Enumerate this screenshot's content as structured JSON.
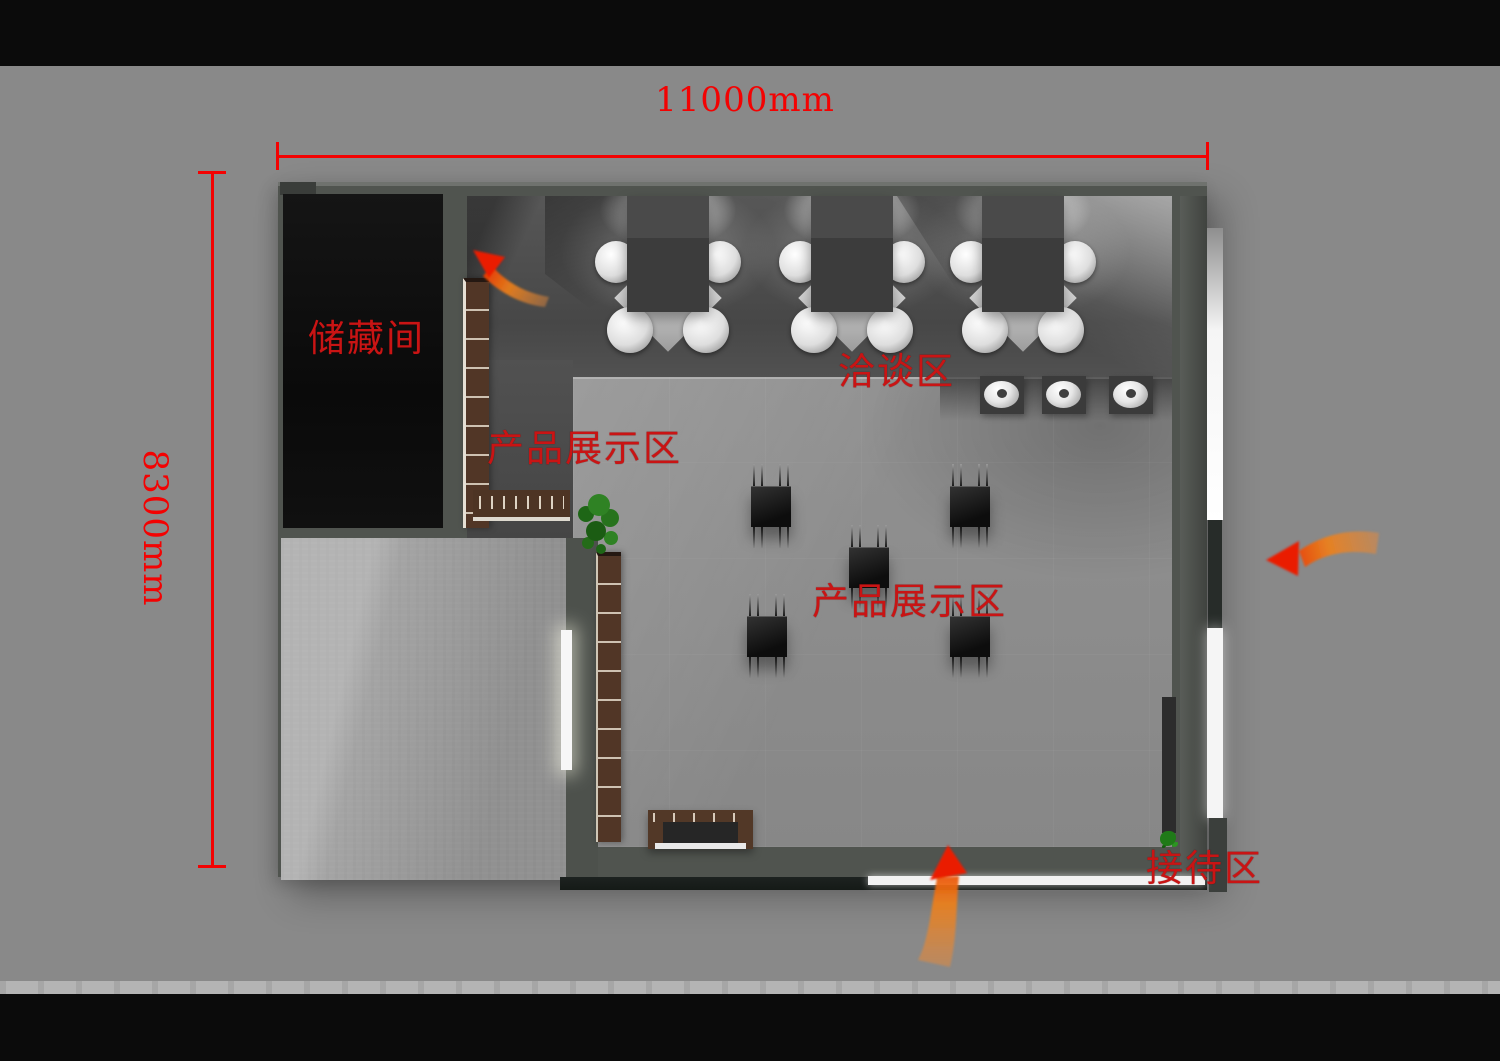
{
  "scene": {
    "kind": "showroom floor plan top-view render",
    "colors": {
      "background": "#898989",
      "letterbox": "#0b0b0b",
      "footer_strip": "#b4b4b4",
      "dimension_red": "#f30202",
      "zone_label_red": "#c91414",
      "wall": "#50544f",
      "platform_floor": "#8d8d8d",
      "storage_floor": "#0d0d0d",
      "arrow_orange": "#f08a28",
      "arrow_red": "#e83000"
    }
  },
  "dimensions": {
    "width_label": "11000mm",
    "height_label": "8300mm"
  },
  "zones": {
    "storage": "储藏间",
    "negotiation": "洽谈区",
    "display_a": "产品展示区",
    "display_b": "产品展示区",
    "reception": "接待区"
  },
  "icons": {
    "flow_arrow_top_left": "curved-flow-arrow",
    "flow_arrow_right": "curved-flow-arrow",
    "flow_arrow_bottom": "curved-flow-arrow"
  }
}
